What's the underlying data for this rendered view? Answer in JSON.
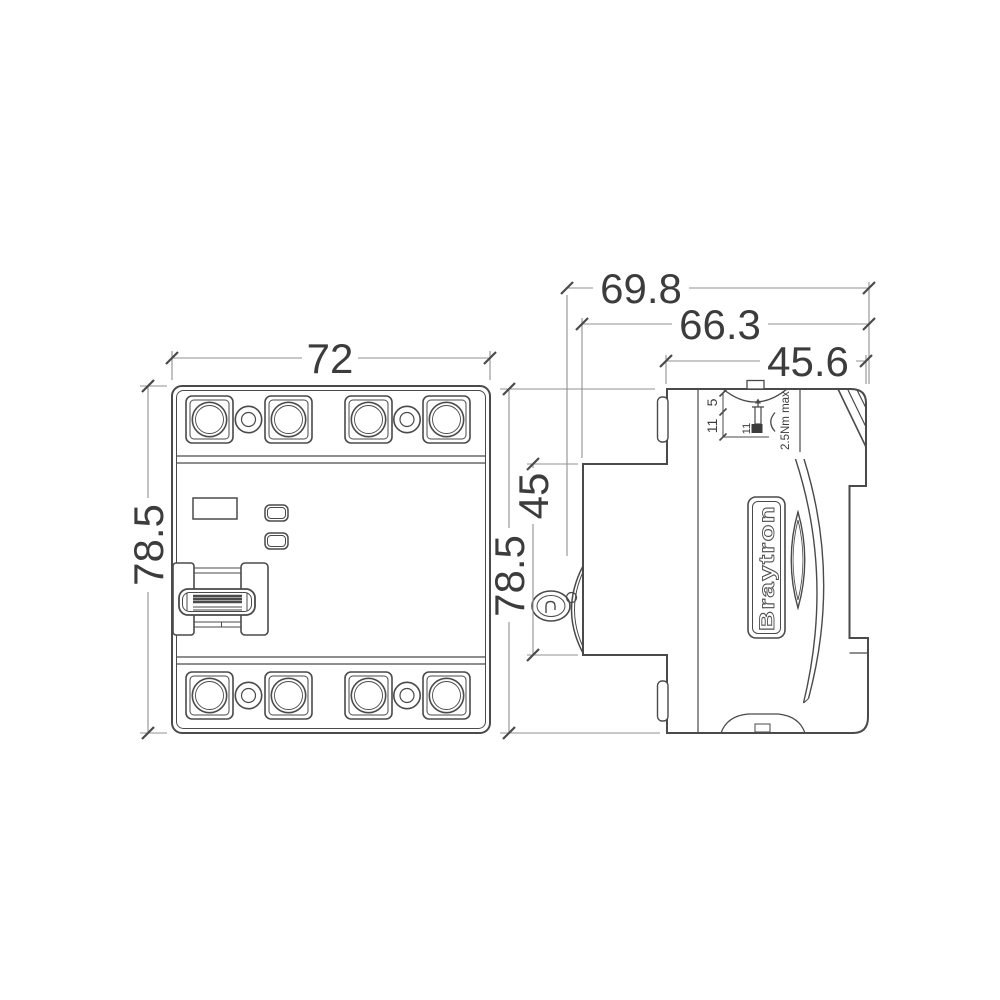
{
  "colors": {
    "device_line": "#4a4a4a",
    "dimension_line": "#909090",
    "text": "#3c3c3c",
    "background": "#ffffff"
  },
  "front_view": {
    "width_dim": "72",
    "height_dim": "78.5"
  },
  "side_view": {
    "height_dim": "78.5",
    "front_step_dim": "45",
    "overall_depth_dim": "69.8",
    "body_depth_dim": "66.3",
    "top_width_dim": "45.6",
    "terminal_opening_dim": "5",
    "terminal_depth_dim": "11",
    "screw_recess_dim": "11",
    "torque_note": "2.5Nm max",
    "brand": "Braytron"
  }
}
